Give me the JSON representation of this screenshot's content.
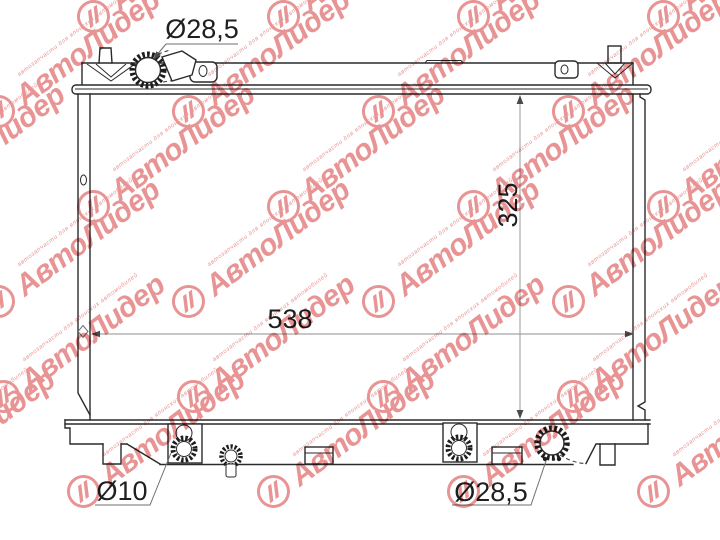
{
  "drawing": {
    "type": "radiator-technical-diagram",
    "labels": {
      "filler_neck_diameter": "Ø28,5",
      "core_width": "538",
      "core_height": "325",
      "drain_diameter": "Ø10",
      "outlet_diameter": "Ø28,5"
    }
  },
  "watermark": {
    "brand": "АвтоЛидер",
    "tagline": "автозапчасти для японских автомобилей"
  },
  "colors": {
    "line": "#2a2a2a",
    "dimension_line": "#8f8f8f",
    "text": "#1f1f1f",
    "watermark": "#e89494",
    "background": "#ffffff"
  }
}
